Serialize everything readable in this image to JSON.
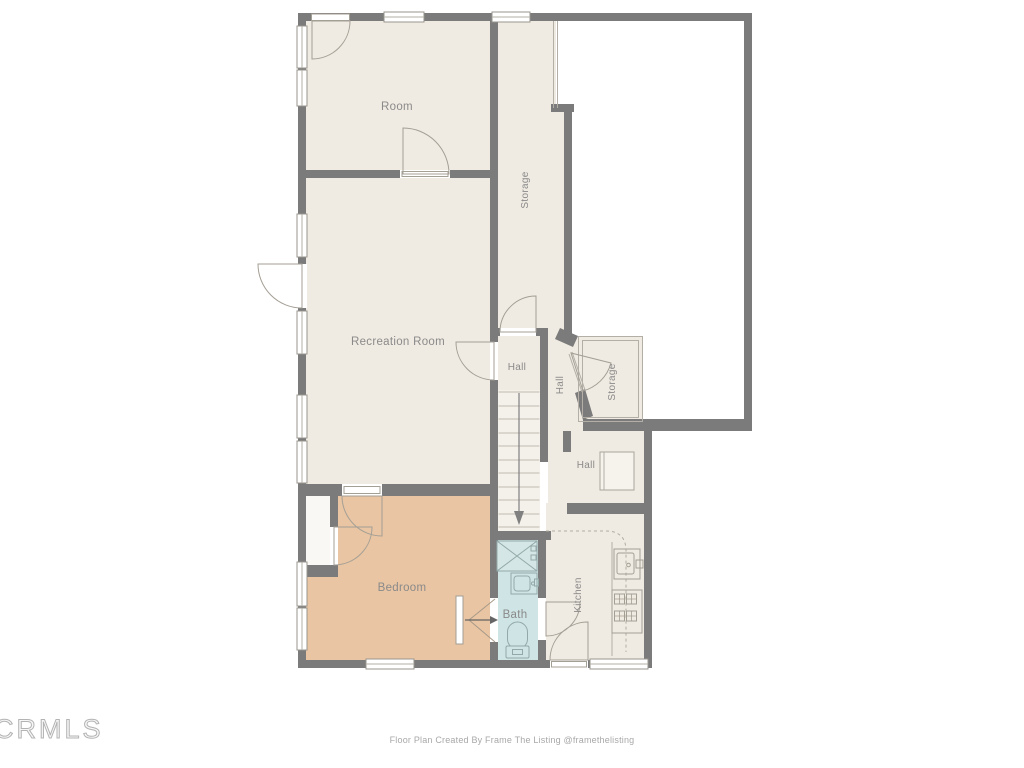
{
  "canvas": {
    "width": 1024,
    "height": 768,
    "background": "#ffffff"
  },
  "palette": {
    "wall": "#7b7b7b",
    "room": "#f0ebe2",
    "bedroom": "#e9c5a3",
    "bath": "#cfe4e4",
    "stairs": "#f4f1eb",
    "closet": "#faf8f4",
    "thin_line": "#b3afa6",
    "label": "#8a8a8a",
    "footer_text": "#a8a8a8",
    "watermark": "#b3b3b3"
  },
  "floor_plan": {
    "rooms": [
      {
        "id": "room",
        "label": "Room"
      },
      {
        "id": "storage-corridor",
        "label": "Storage"
      },
      {
        "id": "recreation-room",
        "label": "Recreation Room"
      },
      {
        "id": "hall-upper",
        "label": "Hall"
      },
      {
        "id": "hall-mid",
        "label": "Hall"
      },
      {
        "id": "storage-small",
        "label": "Storage"
      },
      {
        "id": "hall-lower",
        "label": "Hall"
      },
      {
        "id": "bedroom",
        "label": "Bedroom"
      },
      {
        "id": "bath",
        "label": "Bath"
      },
      {
        "id": "kitchen",
        "label": "Kitchen"
      }
    ]
  },
  "watermark": {
    "text": "CRMLS"
  },
  "footer": {
    "credit": "Floor Plan Created By Frame The Listing @framethelisting"
  }
}
